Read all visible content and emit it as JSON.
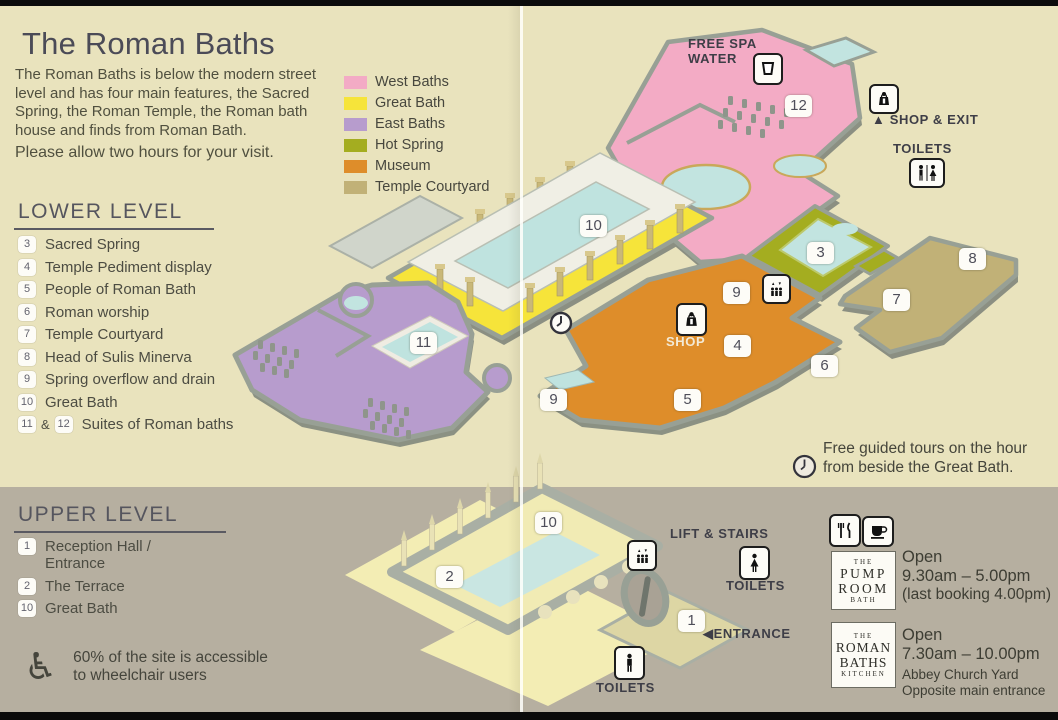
{
  "page": {
    "title": "The Roman Baths",
    "intro": "The Roman Baths is below the modern street level and has four main features, the Sacred Spring, the Roman Temple, the Roman bath house and finds from Roman Bath.",
    "visit_note": "Please allow two hours for your visit."
  },
  "legend": {
    "items": [
      {
        "label": "West Baths",
        "color": "#f3abc5"
      },
      {
        "label": "Great Bath",
        "color": "#f6e43a"
      },
      {
        "label": "East Baths",
        "color": "#b79ccd"
      },
      {
        "label": "Hot Spring",
        "color": "#a4ad20"
      },
      {
        "label": "Museum",
        "color": "#de8d2a"
      },
      {
        "label": "Temple Courtyard",
        "color": "#c1b177"
      }
    ]
  },
  "lower_level": {
    "heading": "LOWER LEVEL",
    "items": [
      {
        "num": "3",
        "label": "Sacred Spring"
      },
      {
        "num": "4",
        "label": "Temple Pediment display"
      },
      {
        "num": "5",
        "label": "People of Roman Bath"
      },
      {
        "num": "6",
        "label": "Roman worship"
      },
      {
        "num": "7",
        "label": "Temple Courtyard"
      },
      {
        "num": "8",
        "label": "Head of Sulis Minerva"
      },
      {
        "num": "9",
        "label": "Spring overflow and drain"
      },
      {
        "num": "10",
        "label": "Great Bath"
      },
      {
        "num": "11",
        "joiner": "&",
        "num2": "12",
        "label": "Suites of Roman baths"
      }
    ]
  },
  "upper_level": {
    "heading": "UPPER LEVEL",
    "items": [
      {
        "num": "1",
        "label": "Reception Hall / Entrance"
      },
      {
        "num": "2",
        "label": "The Terrace"
      },
      {
        "num": "10",
        "label": "Great Bath"
      }
    ]
  },
  "accessibility": {
    "line1": "60% of the site is accessible",
    "line2": "to wheelchair users",
    "icon": "wheelchair-symbol"
  },
  "map": {
    "free_spa_line1": "FREE SPA",
    "free_spa_line2": "WATER",
    "shop_exit_arrow": "▲",
    "shop_exit": "SHOP & EXIT",
    "toilets_top": "TOILETS",
    "shop": "SHOP",
    "tours_line1": "Free guided tours on the hour",
    "tours_line2": "from beside the Great Bath.",
    "lift_stairs": "LIFT & STAIRS",
    "toilets_mid": "TOILETS",
    "entrance_arrow": "◀",
    "entrance": "ENTRANCE",
    "toilets_bottom": "TOILETS",
    "markers_lower": {
      "m12": "12",
      "m10": "10",
      "m3": "3",
      "m9a": "9",
      "m4": "4",
      "m6": "6",
      "m5": "5",
      "m9b": "9",
      "m7": "7",
      "m8": "8",
      "m11": "11"
    },
    "markers_upper": {
      "m2": "2",
      "m10": "10",
      "m1": "1"
    }
  },
  "venues": {
    "pump_room": {
      "logo": [
        "THE",
        "PUMP",
        "ROOM",
        "BATH"
      ],
      "open": "Open",
      "hours": "9.30am – 5.00pm",
      "note": "(last booking 4.00pm)"
    },
    "kitchen": {
      "logo": [
        "THE",
        "ROMAN",
        "BATHS",
        "KITCHEN"
      ],
      "open": "Open",
      "hours": "7.30am – 10.00pm",
      "address1": "Abbey Church Yard",
      "address2": "Opposite main entrance"
    }
  },
  "colors": {
    "paper": "#e9e3bd",
    "lower_band": "#b6afa0",
    "pool_water": "#c2e4e0",
    "wall_gray": "#98a095",
    "text_dark": "#4c4c44"
  }
}
